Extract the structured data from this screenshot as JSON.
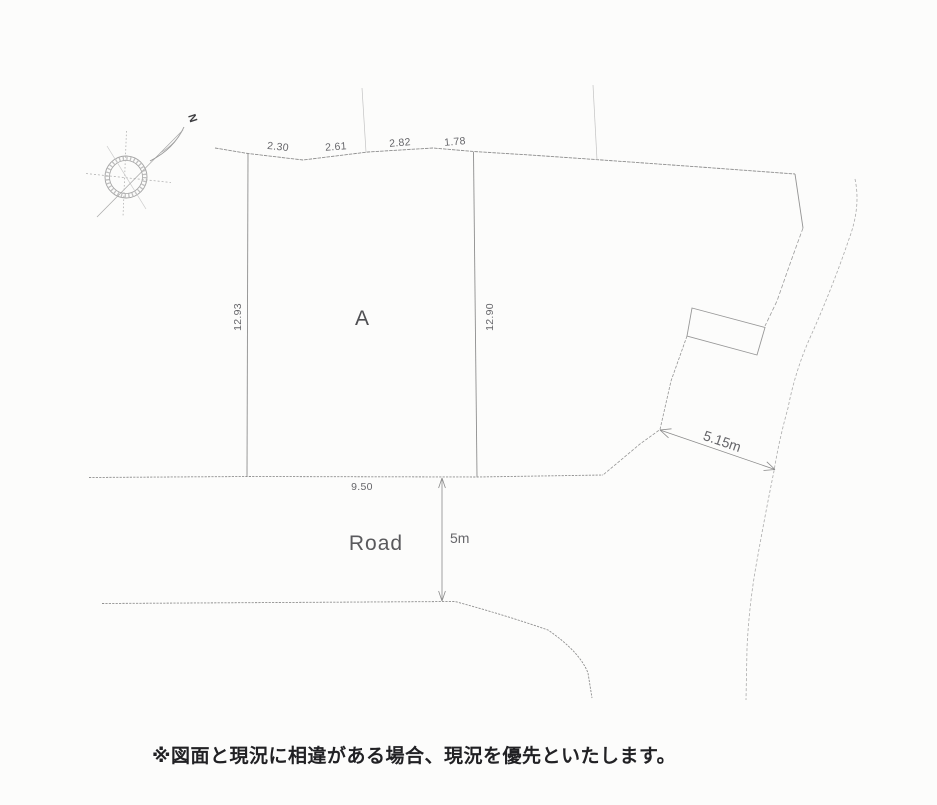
{
  "page": {
    "background": "#fcfcfb"
  },
  "diagram": {
    "north_label": "N",
    "plot_label": "A",
    "road_label": "Road",
    "dimensions": {
      "top_segments": [
        "2.30",
        "2.61",
        "2.82",
        "1.78"
      ],
      "left_side": "12.93",
      "right_side": "12.90",
      "frontage": "9.50",
      "road_width": "5m",
      "side_road_width": "5.15m"
    },
    "note": "※図面と現況に相違がある場合、現況を優先といたします。",
    "colors": {
      "line": "#8e8e8e",
      "faint_line": "#b5b5b5",
      "dim_text": "#66666a",
      "note_text": "#212124"
    }
  }
}
